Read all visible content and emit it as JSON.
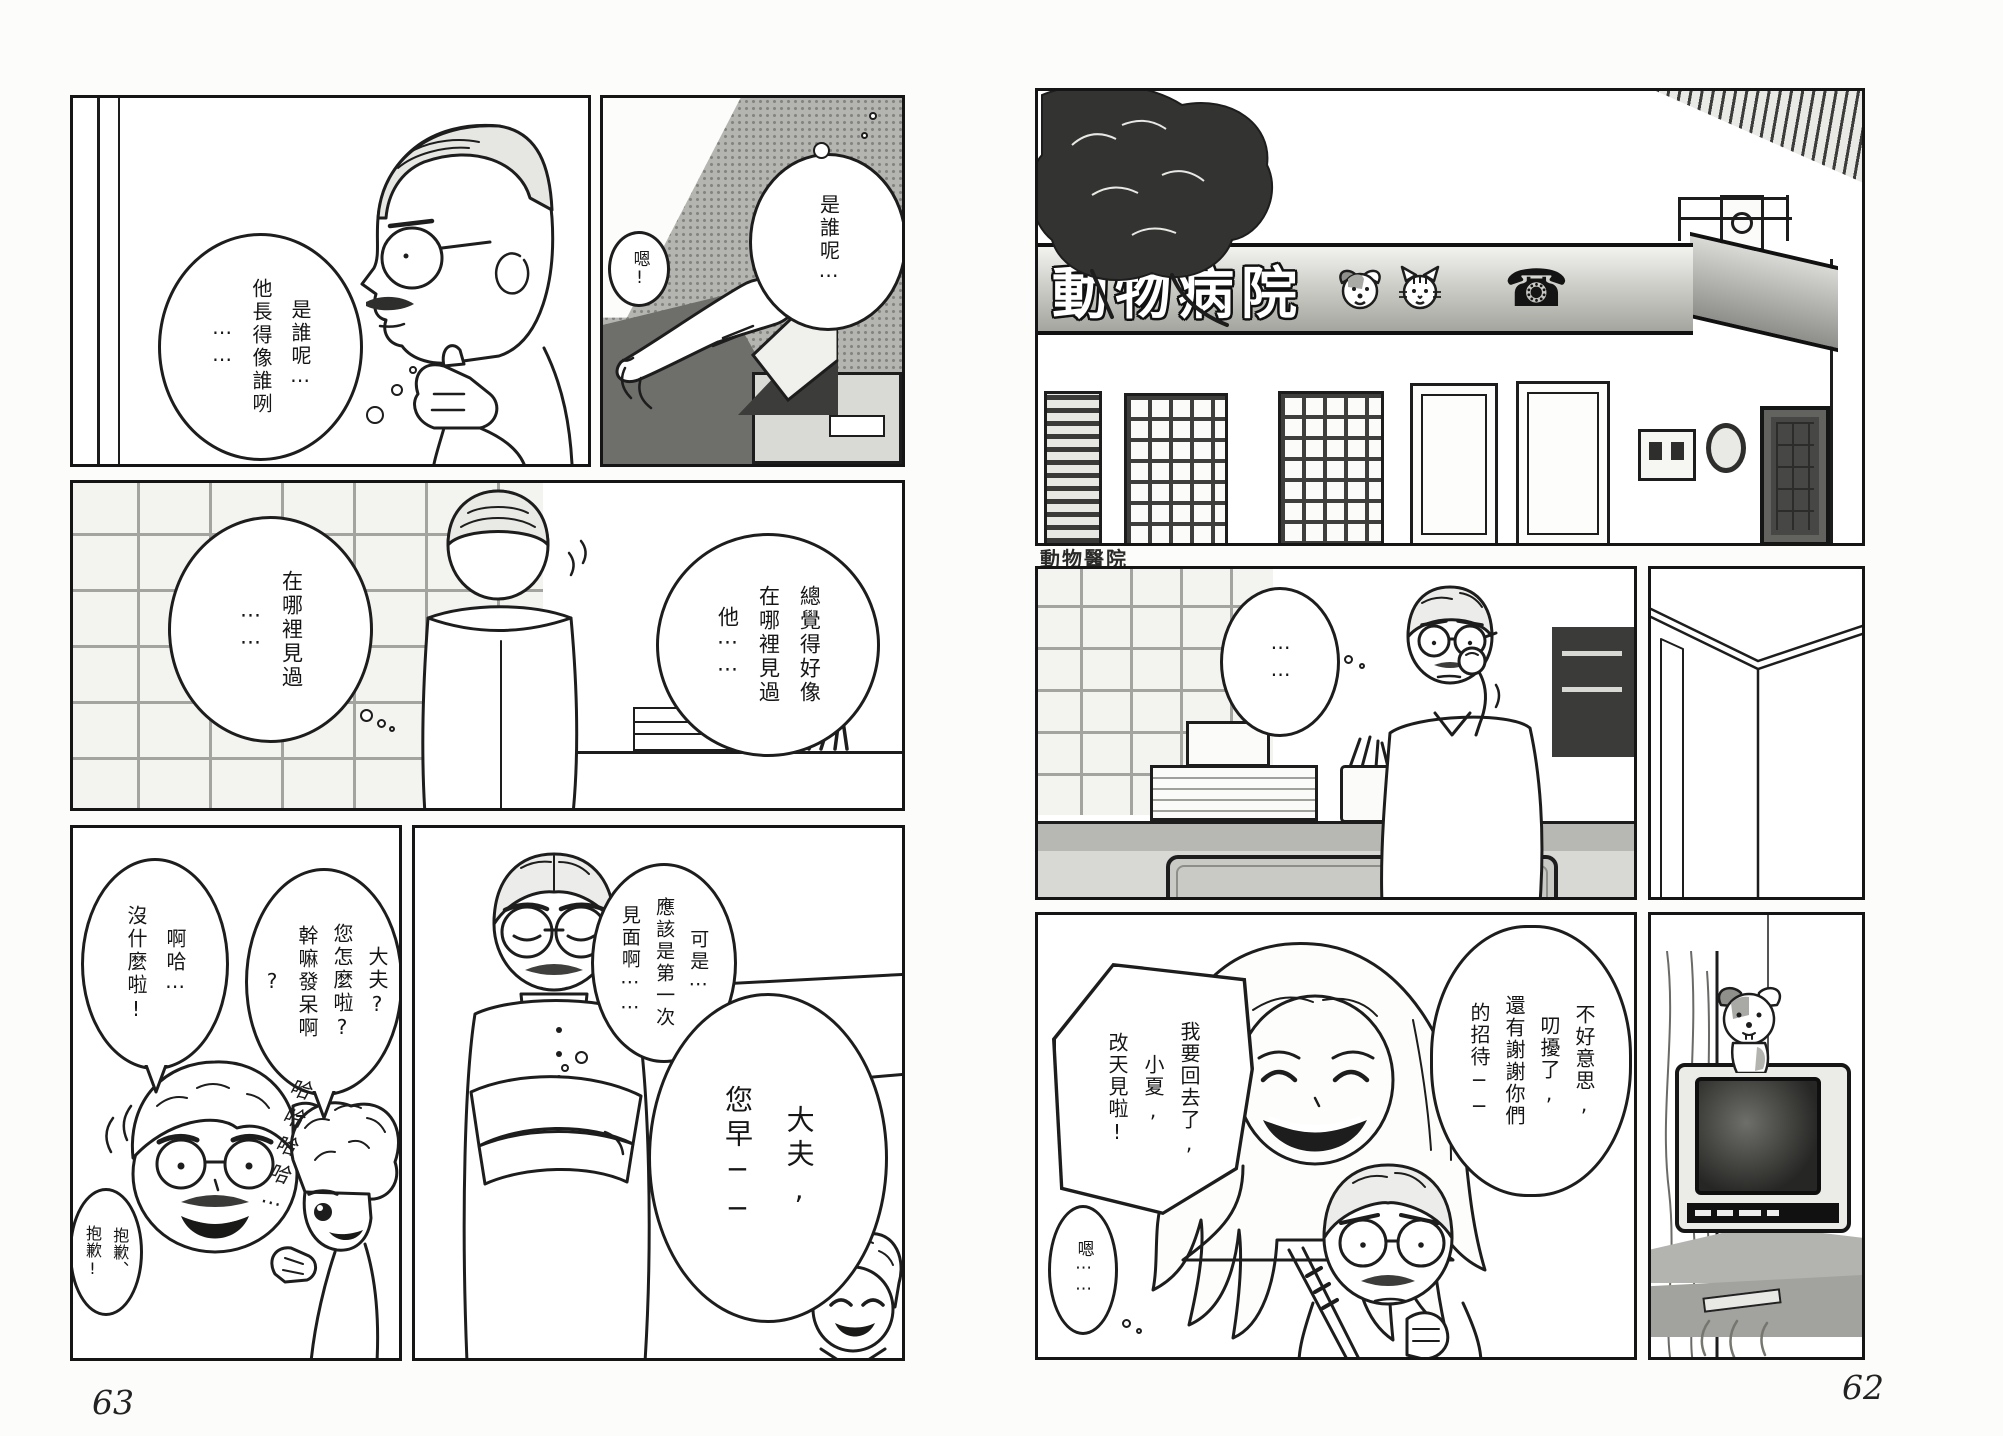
{
  "colors": {
    "ink": "#1d1d1d",
    "sign_band_gray": "#b9b9b5",
    "halftone_gray": "#b4b4b0",
    "tv_screen_dark": "#2f2f2d"
  },
  "left_page": {
    "page_number": "63",
    "panel1": {
      "thought_bubble": "是誰呢⋯\n他長得像誰咧\n⋯⋯"
    },
    "panel2": {
      "sfx_bubble": "嗯!",
      "speech_bubble": "是誰呢⋯"
    },
    "panel3": {
      "thought_bubble_left": "在哪裡見過\n⋯⋯",
      "thought_bubble_right": "總覺得好像\n在哪裡見過\n他⋯⋯"
    },
    "panel4": {
      "doctor_bubble": "啊哈⋯\n沒什麼啦!",
      "boy_bubble": "大夫?\n您怎麼啦?\n幹嘛發呆啊\n?",
      "laugh_sfx": "哈哈哈哈⋯",
      "sorry_bubble": "抱歉、\n抱歉!"
    },
    "panel5": {
      "thought_bubble": "可是⋯\n應該是第一次\n見面啊⋯⋯",
      "greeting_bubble": "大夫,\n您早──"
    }
  },
  "right_page": {
    "page_number": "62",
    "building_sign": {
      "text": "動物病院",
      "phone_glyph": "☎",
      "icons": [
        "dog-face",
        "cat-face",
        "telephone"
      ]
    },
    "entrance_label": "動物醫院",
    "panel7": {
      "thought_bubble": "⋯⋯"
    },
    "panel9": {
      "thanks_bubble": "不好意思,\n叨擾了,\n還有謝謝你們\n的招待──",
      "leaving_bubble": "我要回去了,\n小夏,\n改天見啦!",
      "hmm_bubble": "嗯⋯⋯"
    }
  }
}
